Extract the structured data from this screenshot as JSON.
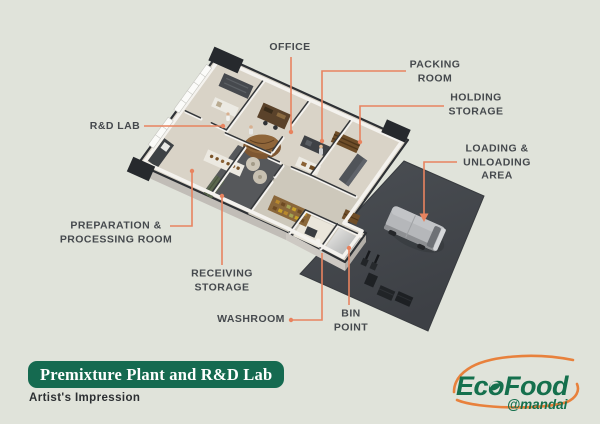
{
  "banner": {
    "title": "Premixture Plant and R&D Lab",
    "subtitle": "Artist's Impression"
  },
  "labels": {
    "office": "OFFICE",
    "packing_room": "PACKING\nROOM",
    "holding_storage": "HOLDING\nSTORAGE",
    "loading_area": "LOADING &\nUNLOADING\nAREA",
    "rd_lab": "R&D LAB",
    "prep_room": "PREPARATION &\nPROCESSING ROOM",
    "receiving_storage": "RECEIVING\nSTORAGE",
    "washroom": "WASHROOM",
    "bin_point": "BIN\nPOINT"
  },
  "logo": {
    "brand": "EcoFood",
    "handle": "@mandai"
  },
  "colors": {
    "background": "#e0e3da",
    "accent_orange": "#e8835f",
    "banner_green": "#156a50",
    "logo_green": "#15704d",
    "logo_orange": "#e8813c",
    "label_text": "#45494d",
    "dock_gray": "#45484d",
    "floor_beige": "#d9d3c7"
  }
}
